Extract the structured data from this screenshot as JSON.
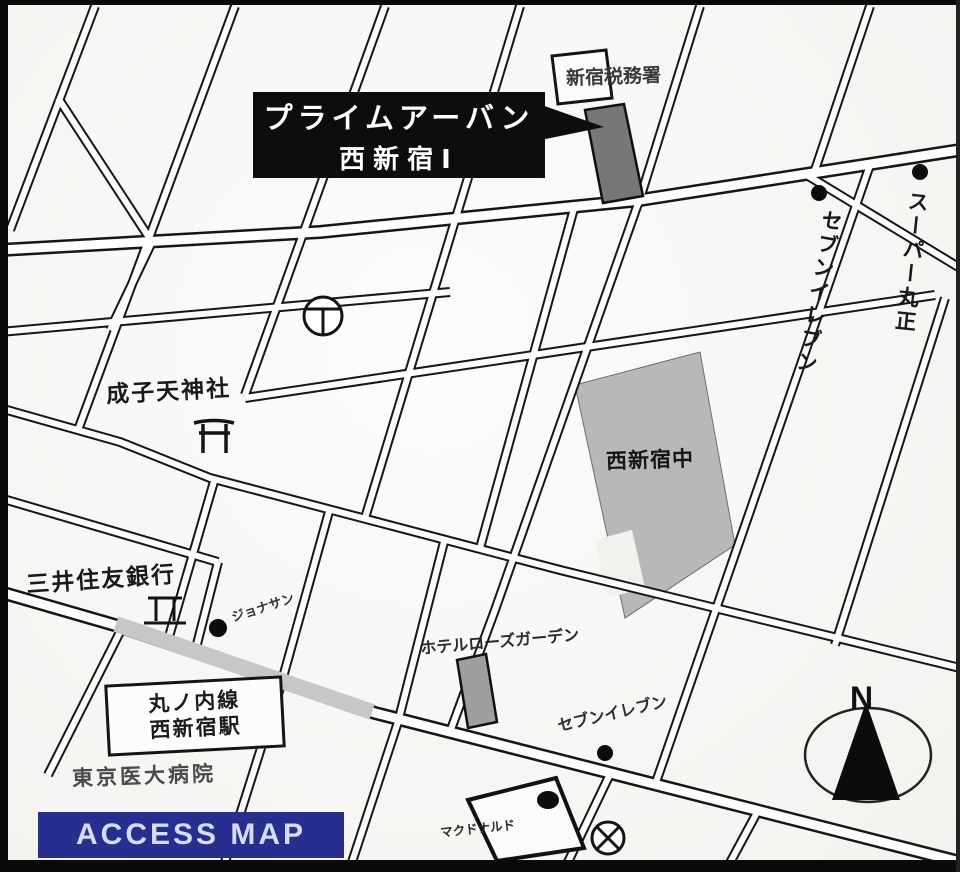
{
  "callout": {
    "line1": "プライムアーバン",
    "line2": "西新宿Ⅰ"
  },
  "labels": {
    "tax_office": "新宿税務署",
    "seven_eleven_right": "セブンイレブン",
    "super_marusho": "スーパー丸正",
    "naruko_shrine": "成子天神社",
    "nishi_shinjuku_school": "西新宿中",
    "smbc_bank": "三井住友銀行",
    "jonathans": "ジョナサン",
    "hotel_rose_garden": "ホテルローズガーデン",
    "station_line": "丸ノ内線",
    "station_name": "西新宿駅",
    "tokyo_medical_hospital": "東京医大病院",
    "seven_eleven_bottom": "セブンイレブン",
    "mcdonalds": "マクドナルド",
    "compass_north": "N",
    "access_map": "ACCESS MAP"
  },
  "icons": {
    "torii": "shrine torii gate map symbol",
    "bank": "bank map symbol",
    "police_box": "circled X police-box map symbol",
    "utility": "circled Y utility map symbol",
    "north_arrow": "compass arrow in ellipse",
    "poi_dot": "black point-of-interest dot",
    "callout_arrow": "black pointer from callout to building"
  },
  "colors": {
    "callout_bg": "#0d0d0d",
    "callout_text": "#ffffff",
    "highlight_building": "#777777",
    "school_fill": "#b8b8b8",
    "road_highlight": "#c7c7c7",
    "access_map_bg": "#272f8e",
    "access_map_text": "#d6dbf7"
  }
}
